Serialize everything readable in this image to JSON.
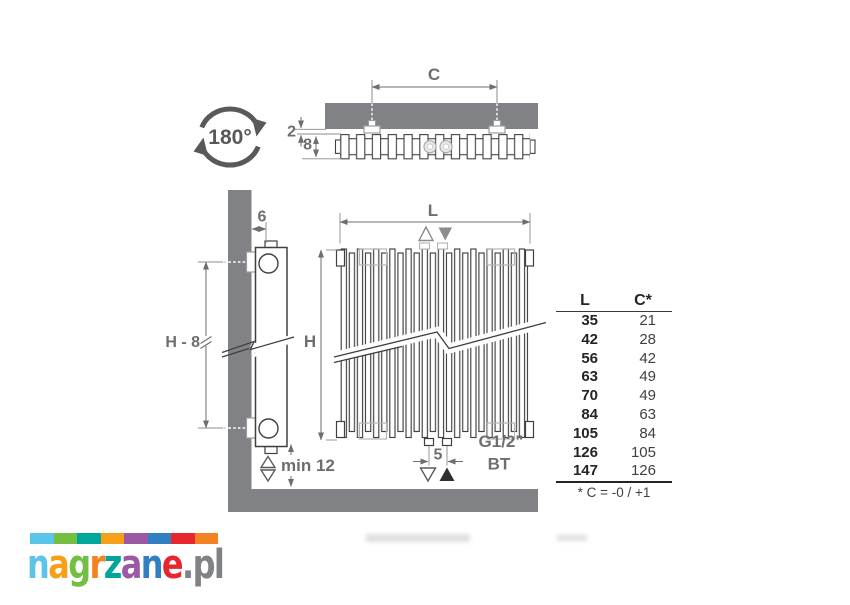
{
  "colors": {
    "wall_gray": "#808285",
    "line_dark": "#404041",
    "dim_gray": "#6d6e71",
    "collar_gray": "#b3b4b6"
  },
  "top_view": {
    "rotation_label": "180°",
    "dim_c": "C",
    "dim_gap": "2",
    "dim_depth": "8"
  },
  "side_view": {
    "dim_wall_offset": "6",
    "dim_height": "H - 8",
    "dim_floor_clearance": "min 12"
  },
  "front_view": {
    "dim_width": "L",
    "dim_height": "H",
    "dim_pipe_spacing": "5",
    "connection_thread": "G1/2\"",
    "connection_type": "BT"
  },
  "table": {
    "headers": [
      "L",
      "C*"
    ],
    "rows": [
      [
        "35",
        "21"
      ],
      [
        "42",
        "28"
      ],
      [
        "56",
        "42"
      ],
      [
        "63",
        "49"
      ],
      [
        "70",
        "49"
      ],
      [
        "84",
        "63"
      ],
      [
        "105",
        "84"
      ],
      [
        "126",
        "105"
      ],
      [
        "147",
        "126"
      ]
    ],
    "footnote": "* C = -0 / +1"
  },
  "logo": {
    "text": "nagrzane.pl",
    "letters": [
      {
        "char": "n",
        "color": "#5bc5e9"
      },
      {
        "char": "a",
        "color": "#f6a01a"
      },
      {
        "char": "g",
        "color": "#72bf44"
      },
      {
        "char": "r",
        "color": "#f58220"
      },
      {
        "char": "z",
        "color": "#00a69c"
      },
      {
        "char": "a",
        "color": "#9b59a5"
      },
      {
        "char": "n",
        "color": "#2f7fc1"
      },
      {
        "char": "e",
        "color": "#e8262d"
      },
      {
        "char": ".",
        "color": "#808285"
      },
      {
        "char": "p",
        "color": "#808285"
      },
      {
        "char": "l",
        "color": "#808285"
      }
    ],
    "squares": [
      "#5bc5e9",
      "#72bf44",
      "#00a69c",
      "#f6a01a",
      "#9b59a5",
      "#2f7fc1",
      "#e8262d",
      "#f58220"
    ]
  }
}
